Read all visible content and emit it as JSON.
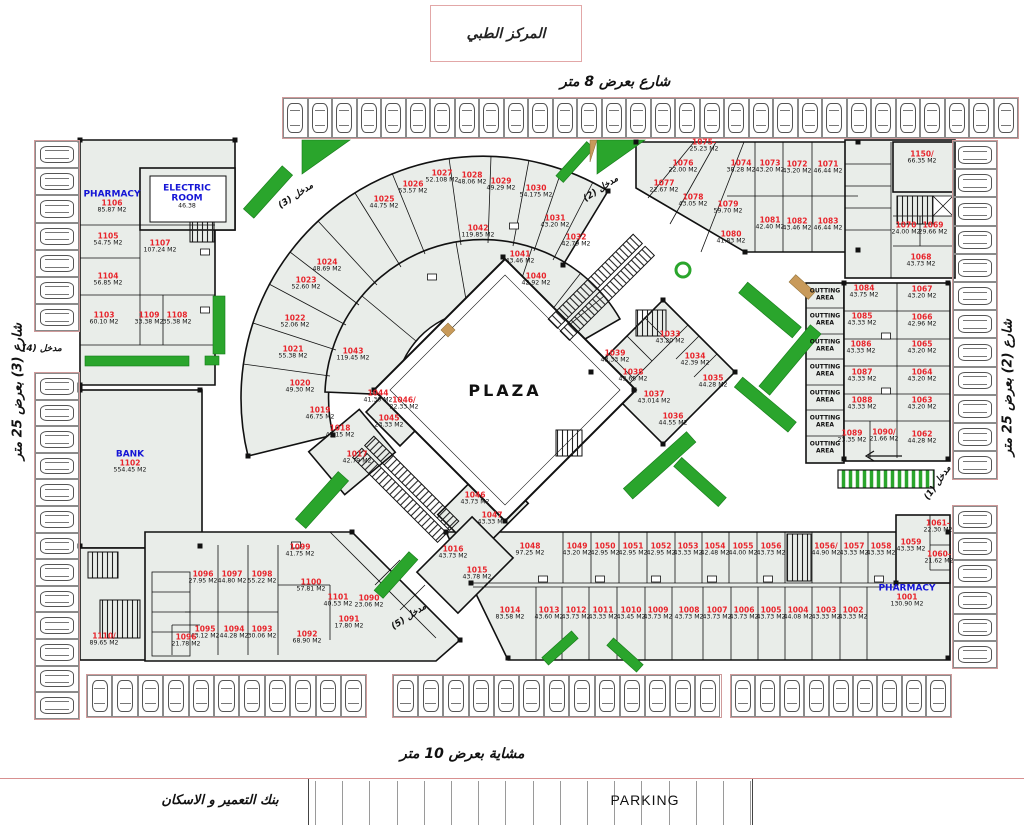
{
  "title": "المركز الطبي",
  "plaza_label": "PLAZA",
  "streets": {
    "top": "شارع بعرض 8 متر",
    "left": "شارع (3) بعرض 25 متر",
    "right": "شارع (2) بعرض 25 متر",
    "walkway": "مشاية بعرض 10 متر"
  },
  "bottom_band": {
    "bank": "بنك التعمير و الاسكان",
    "parking": "PARKING"
  },
  "colors": {
    "unit_number": "#e8252c",
    "area_text": "#111111",
    "blue_label": "#1515d6",
    "green": "#2aa52c",
    "tan": "#c89a5a",
    "unit_fill": "#e9ede9",
    "wall": "#111111",
    "pink": "#d89090"
  },
  "outting": {
    "label": "OUTTING\nAREA",
    "x": 825,
    "ys": [
      295,
      320,
      346,
      371,
      397,
      422,
      448
    ]
  },
  "entrances": [
    {
      "label": "مدخل (3)",
      "x": 296,
      "y": 196,
      "r": -33
    },
    {
      "label": "مدخل (2)",
      "x": 601,
      "y": 189,
      "r": -33
    },
    {
      "label": "مدخل (4)",
      "x": 42,
      "y": 349,
      "r": 0
    },
    {
      "label": "مدخل (5)",
      "x": 409,
      "y": 617,
      "r": -33
    },
    {
      "label": "مدخل (1)",
      "x": 938,
      "y": 483,
      "r": -55
    }
  ],
  "units": [
    {
      "t": "PHARMACY",
      "n": "1106",
      "a": "85.87 M2",
      "x": 112,
      "y": 202
    },
    {
      "t": "ELECTRIC\nROOM",
      "a": "46.38",
      "x": 187,
      "y": 197
    },
    {
      "n": "1105",
      "a": "54.75 M2",
      "x": 108,
      "y": 240
    },
    {
      "n": "1107",
      "a": "107.24 M2",
      "x": 160,
      "y": 247
    },
    {
      "n": "1104",
      "a": "56.85 M2",
      "x": 108,
      "y": 280
    },
    {
      "n": "1103",
      "a": "60.10 M2",
      "x": 104,
      "y": 319
    },
    {
      "n": "1109",
      "a": "33.38 M2",
      "x": 149,
      "y": 319
    },
    {
      "n": "1108",
      "a": "35.38 M2",
      "x": 177,
      "y": 319
    },
    {
      "t": "BANK",
      "n": "1102",
      "a": "554.45 M2",
      "x": 130,
      "y": 462
    },
    {
      "n": "1110/",
      "a": "89.65 M2",
      "x": 104,
      "y": 640
    },
    {
      "n": "1018",
      "a": "45.15 M2",
      "x": 340,
      "y": 432
    },
    {
      "n": "1019",
      "a": "46.75 M2",
      "x": 320,
      "y": 414
    },
    {
      "n": "1020",
      "a": "49.30 M2",
      "x": 300,
      "y": 387
    },
    {
      "n": "1021",
      "a": "55.38 M2",
      "x": 293,
      "y": 353
    },
    {
      "n": "1022",
      "a": "52.06 M2",
      "x": 295,
      "y": 322
    },
    {
      "n": "1023",
      "a": "52.60 M2",
      "x": 306,
      "y": 284
    },
    {
      "n": "1024",
      "a": "48.69 M2",
      "x": 327,
      "y": 266
    },
    {
      "n": "1025",
      "a": "44.75 M2",
      "x": 384,
      "y": 203
    },
    {
      "n": "1026",
      "a": "53.57 M2",
      "x": 413,
      "y": 188
    },
    {
      "n": "1027",
      "a": "52.108 M2",
      "x": 442,
      "y": 177
    },
    {
      "n": "1028",
      "a": "48.06 M2",
      "x": 472,
      "y": 179
    },
    {
      "n": "1029",
      "a": "49.29 M2",
      "x": 501,
      "y": 185
    },
    {
      "n": "1030",
      "a": "54.175 M2",
      "x": 536,
      "y": 192
    },
    {
      "n": "1031",
      "a": "43.20 M2",
      "x": 555,
      "y": 222
    },
    {
      "n": "1032",
      "a": "42.79 M2",
      "x": 576,
      "y": 241
    },
    {
      "n": "1042",
      "a": "119.85 M2",
      "x": 478,
      "y": 232
    },
    {
      "n": "1041",
      "a": "43.46 M2",
      "x": 520,
      "y": 258
    },
    {
      "n": "1040",
      "a": "42.92 M2",
      "x": 536,
      "y": 280
    },
    {
      "n": "1043",
      "a": "119.45 M2",
      "x": 353,
      "y": 355
    },
    {
      "n": "1044",
      "a": "41.30 M2",
      "x": 378,
      "y": 397
    },
    {
      "n": "1046/",
      "a": "22.33 M2",
      "x": 404,
      "y": 404
    },
    {
      "n": "1045",
      "a": "23.33 M2",
      "x": 389,
      "y": 422
    },
    {
      "n": "1017",
      "a": "42.79 M2",
      "x": 357,
      "y": 458
    },
    {
      "n": "1046",
      "a": "43.73 M2",
      "x": 475,
      "y": 499
    },
    {
      "n": "1047",
      "a": "43.33 M2",
      "x": 492,
      "y": 519
    },
    {
      "n": "1016",
      "a": "43.73 M2",
      "x": 453,
      "y": 553
    },
    {
      "n": "1015",
      "a": "43.78 M2",
      "x": 477,
      "y": 574
    },
    {
      "n": "1033",
      "a": "43.20 M2",
      "x": 670,
      "y": 338
    },
    {
      "n": "1034",
      "a": "42.39 M2",
      "x": 695,
      "y": 360
    },
    {
      "n": "1035",
      "a": "44.28 M2",
      "x": 713,
      "y": 382
    },
    {
      "n": "1036",
      "a": "44.55 M2",
      "x": 673,
      "y": 420
    },
    {
      "n": "1037",
      "a": "43.014 M2",
      "x": 654,
      "y": 398
    },
    {
      "n": "1038",
      "a": "43.65 M2",
      "x": 633,
      "y": 376
    },
    {
      "n": "1039",
      "a": "43.33 M2",
      "x": 615,
      "y": 357
    },
    {
      "n": "1075-",
      "a": "25.23 M2",
      "x": 704,
      "y": 146
    },
    {
      "n": "1076",
      "a": "22.00 M2",
      "x": 683,
      "y": 167
    },
    {
      "n": "1077",
      "a": "22.67 M2",
      "x": 664,
      "y": 187
    },
    {
      "n": "1078",
      "a": "43.05 M2",
      "x": 693,
      "y": 201
    },
    {
      "n": "1079",
      "a": "59.70 M2",
      "x": 728,
      "y": 208
    },
    {
      "n": "1074",
      "a": "38.28 M2",
      "x": 741,
      "y": 167
    },
    {
      "n": "1073",
      "a": "43.20 M2",
      "x": 770,
      "y": 167
    },
    {
      "n": "1072",
      "a": "43.20 M2",
      "x": 797,
      "y": 168
    },
    {
      "n": "1071",
      "a": "46.44 M2",
      "x": 828,
      "y": 168
    },
    {
      "n": "1081",
      "a": "42.40 M2",
      "x": 770,
      "y": 224
    },
    {
      "n": "1082",
      "a": "43.46 M2",
      "x": 797,
      "y": 225
    },
    {
      "n": "1083",
      "a": "46.44 M2",
      "x": 828,
      "y": 225
    },
    {
      "n": "1080",
      "a": "41.83 M2",
      "x": 731,
      "y": 238
    },
    {
      "n": "1150/",
      "a": "66.35 M2",
      "x": 922,
      "y": 158
    },
    {
      "n": "1070",
      "a": "24.00 M2",
      "x": 906,
      "y": 229
    },
    {
      "n": "1069",
      "a": "29.66 M2",
      "x": 933,
      "y": 229
    },
    {
      "n": "1068",
      "a": "43.73 M2",
      "x": 921,
      "y": 261
    },
    {
      "n": "1084",
      "a": "43.75 M2",
      "x": 864,
      "y": 292
    },
    {
      "n": "1067",
      "a": "43.20 M2",
      "x": 922,
      "y": 293
    },
    {
      "n": "1085",
      "a": "43.33 M2",
      "x": 862,
      "y": 320
    },
    {
      "n": "1066",
      "a": "42.96 M2",
      "x": 922,
      "y": 321
    },
    {
      "n": "1086",
      "a": "43.33 M2",
      "x": 861,
      "y": 348
    },
    {
      "n": "1065",
      "a": "43.20 M2",
      "x": 922,
      "y": 348
    },
    {
      "n": "1087",
      "a": "43.33 M2",
      "x": 862,
      "y": 376
    },
    {
      "n": "1064",
      "a": "43.20 M2",
      "x": 922,
      "y": 376
    },
    {
      "n": "1088",
      "a": "43.33 M2",
      "x": 862,
      "y": 404
    },
    {
      "n": "1063",
      "a": "43.20 M2",
      "x": 922,
      "y": 404
    },
    {
      "n": "1089",
      "a": "23.35 M2",
      "x": 852,
      "y": 437
    },
    {
      "n": "1090/",
      "a": "21.66 M2",
      "x": 884,
      "y": 436
    },
    {
      "n": "1062",
      "a": "44.28 M2",
      "x": 922,
      "y": 438
    },
    {
      "n": "1061-",
      "a": "22.30 M2",
      "x": 938,
      "y": 527
    },
    {
      "n": "1059",
      "a": "43.33 M2",
      "x": 911,
      "y": 546
    },
    {
      "n": "1060-",
      "a": "21.62 M2",
      "x": 939,
      "y": 558
    },
    {
      "t": "PHARMACY",
      "n": "1001",
      "a": "130.90 M2",
      "x": 907,
      "y": 596
    },
    {
      "n": "1048",
      "a": "97.25 M2",
      "x": 530,
      "y": 550
    },
    {
      "n": "1049",
      "a": "43.20 M2",
      "x": 577,
      "y": 550
    },
    {
      "n": "1050",
      "a": "42.95 M2",
      "x": 605,
      "y": 550
    },
    {
      "n": "1051",
      "a": "42.95 M2",
      "x": 633,
      "y": 550
    },
    {
      "n": "1052",
      "a": "42.95 M2",
      "x": 661,
      "y": 550
    },
    {
      "n": "1053",
      "a": "43.33 M2",
      "x": 688,
      "y": 550
    },
    {
      "n": "1054",
      "a": "42.48 M2",
      "x": 715,
      "y": 550
    },
    {
      "n": "1055",
      "a": "44.00 M2",
      "x": 743,
      "y": 550
    },
    {
      "n": "1056",
      "a": "43.73 M2",
      "x": 771,
      "y": 550
    },
    {
      "n": "1056/",
      "a": "44.90 M2",
      "x": 826,
      "y": 550
    },
    {
      "n": "1057",
      "a": "43.33 M2",
      "x": 854,
      "y": 550
    },
    {
      "n": "1058",
      "a": "43.33 M2",
      "x": 881,
      "y": 550
    },
    {
      "n": "1014",
      "a": "83.58 M2",
      "x": 510,
      "y": 614
    },
    {
      "n": "1013",
      "a": "43.60 M2",
      "x": 549,
      "y": 614
    },
    {
      "n": "1012",
      "a": "43.73 M2",
      "x": 576,
      "y": 614
    },
    {
      "n": "1011",
      "a": "43.33 M2",
      "x": 603,
      "y": 614
    },
    {
      "n": "1010",
      "a": "43.45 M2",
      "x": 631,
      "y": 614
    },
    {
      "n": "1009",
      "a": "43.73 M2",
      "x": 658,
      "y": 614
    },
    {
      "n": "1008",
      "a": "43.73 M2",
      "x": 689,
      "y": 614
    },
    {
      "n": "1007",
      "a": "43.73 M2",
      "x": 717,
      "y": 614
    },
    {
      "n": "1006",
      "a": "43.73 M2",
      "x": 744,
      "y": 614
    },
    {
      "n": "1005",
      "a": "43.73 M2",
      "x": 771,
      "y": 614
    },
    {
      "n": "1004",
      "a": "44.08 M2",
      "x": 798,
      "y": 614
    },
    {
      "n": "1003",
      "a": "43.33 M2",
      "x": 826,
      "y": 614
    },
    {
      "n": "1002",
      "a": "43.33 M2",
      "x": 853,
      "y": 614
    },
    {
      "n": "1099",
      "a": "41.75 M2",
      "x": 300,
      "y": 551
    },
    {
      "n": "1096",
      "a": "27.95 M2",
      "x": 203,
      "y": 578
    },
    {
      "n": "1097",
      "a": "44.80 M2",
      "x": 232,
      "y": 578
    },
    {
      "n": "1098",
      "a": "55.22 M2",
      "x": 262,
      "y": 578
    },
    {
      "n": "1100",
      "a": "57.81 M2",
      "x": 311,
      "y": 586
    },
    {
      "n": "1101",
      "a": "40.53 M2",
      "x": 338,
      "y": 601
    },
    {
      "n": "1090",
      "a": "23.06 M2",
      "x": 369,
      "y": 602
    },
    {
      "n": "1091",
      "a": "17.80 M2",
      "x": 349,
      "y": 623
    },
    {
      "n": "1095",
      "a": "43.12 M2",
      "x": 205,
      "y": 633
    },
    {
      "n": "1094",
      "a": "44.28 M2",
      "x": 234,
      "y": 633
    },
    {
      "n": "1093",
      "a": "30.06 M2",
      "x": 262,
      "y": 633
    },
    {
      "n": "1092",
      "a": "68.90 M2",
      "x": 307,
      "y": 638
    },
    {
      "n": "1096",
      "a": "21.78 M2",
      "x": 186,
      "y": 641
    }
  ],
  "parking_strips": [
    {
      "x": 282,
      "y": 97,
      "dir": "v",
      "count": 30,
      "sw": 24.5,
      "sh": 40
    },
    {
      "x": 34,
      "y": 140,
      "dir": "h",
      "count": 7,
      "sw": 44,
      "sh": 27.2
    },
    {
      "x": 34,
      "y": 372,
      "dir": "h",
      "count": 13,
      "sw": 44,
      "sh": 26.6
    },
    {
      "x": 952,
      "y": 140,
      "dir": "h",
      "count": 12,
      "sw": 44,
      "sh": 28.2
    },
    {
      "x": 952,
      "y": 505,
      "dir": "h",
      "count": 6,
      "sw": 44,
      "sh": 27
    },
    {
      "x": 86,
      "y": 674,
      "dir": "v",
      "count": 11,
      "sw": 25.4,
      "sh": 42
    },
    {
      "x": 392,
      "y": 674,
      "dir": "v",
      "count": 13,
      "sw": 25.2,
      "sh": 42
    },
    {
      "x": 730,
      "y": 674,
      "dir": "v",
      "count": 9,
      "sw": 24.4,
      "sh": 42
    }
  ],
  "band_stalls": {
    "x": 315,
    "count": 16,
    "step": 27.2
  }
}
